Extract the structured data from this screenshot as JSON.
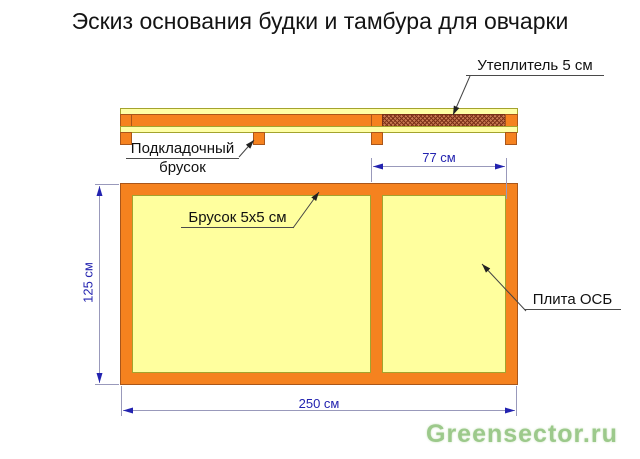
{
  "title": "Эскиз основания будки и тамбура для овчарки",
  "side_view": {
    "insulation_label": "Утеплитель 5 см",
    "backing_label_line1": "Подкладочный",
    "backing_label_line2": "брусок"
  },
  "plan_view": {
    "bar_label": "Брусок 5х5 см",
    "osb_label": "Плита ОСБ"
  },
  "dimensions": {
    "inner_width": "77 см",
    "height": "125 см",
    "total_width": "250 см"
  },
  "watermark": "Greensector.ru",
  "colors": {
    "orange": "#f5821f",
    "orange_border": "#a9561a",
    "yellow": "#ffffa6",
    "yellow_border": "#a3a32e",
    "plan_yellow": "#ffff9e",
    "hatch_base": "#c97a52",
    "hatch_line": "#7a3018",
    "dim_line": "#9999bb",
    "dim_blue": "#2323b0",
    "leader": "#4a4a4a",
    "watermark_green": "#9cc98b",
    "title_color": "#141414"
  }
}
